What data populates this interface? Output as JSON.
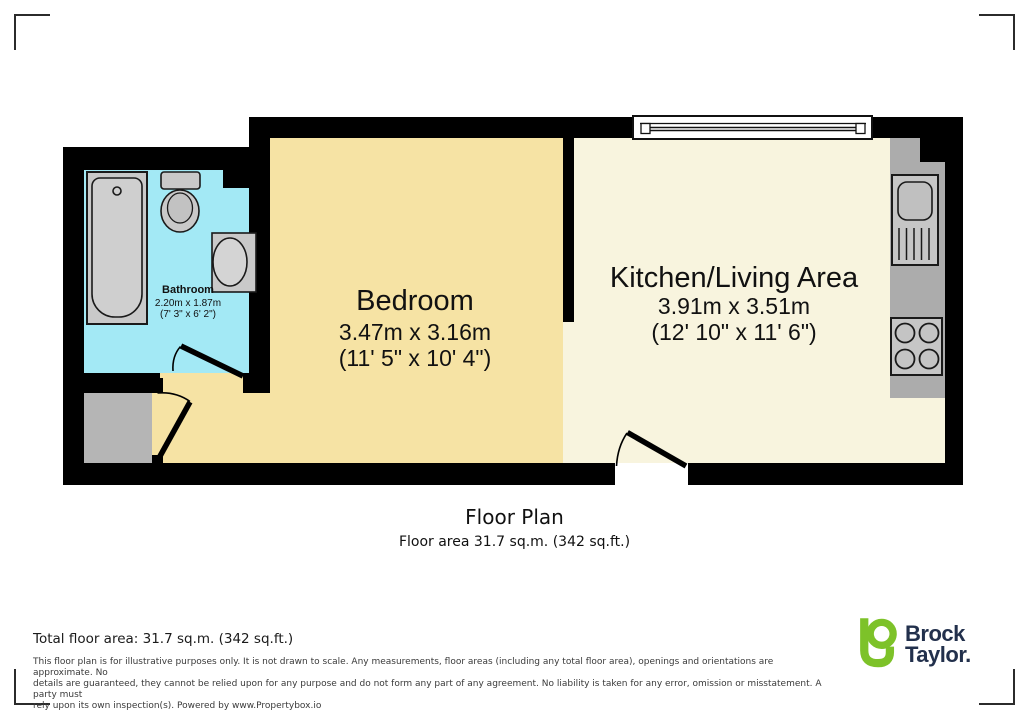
{
  "plan": {
    "title": "Floor Plan",
    "subtitle": "Floor area 31.7 sq.m. (342 sq.ft.)",
    "rooms": {
      "bathroom": {
        "name": "Bathroom",
        "metric": "2.20m x 1.87m",
        "imperial": "(7' 3\" x 6' 2\")"
      },
      "bedroom": {
        "name": "Bedroom",
        "metric": "3.47m x 3.16m",
        "imperial": "(11' 5\" x 10' 4\")"
      },
      "kitchen": {
        "name": "Kitchen/Living Area",
        "metric": "3.91m x 3.51m",
        "imperial": "(12' 10\" x 11' 6\")"
      }
    },
    "fixtures": [
      "bathtub",
      "toilet",
      "bathroom-sink",
      "kitchen-sink",
      "hob",
      "window",
      "worktop"
    ]
  },
  "footer": {
    "total_area": "Total floor area: 31.7 sq.m. (342 sq.ft.)",
    "disclaimer_lines": [
      "This floor plan is for illustrative purposes only. It is not drawn to scale. Any measurements, floor areas (including any total floor area), openings and orientations are approximate. No",
      "details are guaranteed, they cannot be relied upon for any purpose and do not form any part of any agreement. No liability is taken for any error, omission or misstatement. A party must",
      "rely upon its own inspection(s). Powered by www.Propertybox.io"
    ]
  },
  "branding": {
    "brand_line1": "Brock",
    "brand_line2": "Taylor.",
    "logo_icon": "brock-taylor-b-logo"
  },
  "colors": {
    "wall": "#000000",
    "bathroom_floor": "#A3E9F5",
    "bedroom_floor": "#F6E3A4",
    "kitchen_floor": "#F8F4DE",
    "hallway_floor": "#B5B5B5",
    "counter": "#ACACAC",
    "fixture_fill": "#C9C9C9",
    "logo_green": "#7DC229",
    "logo_navy": "#22304C"
  }
}
